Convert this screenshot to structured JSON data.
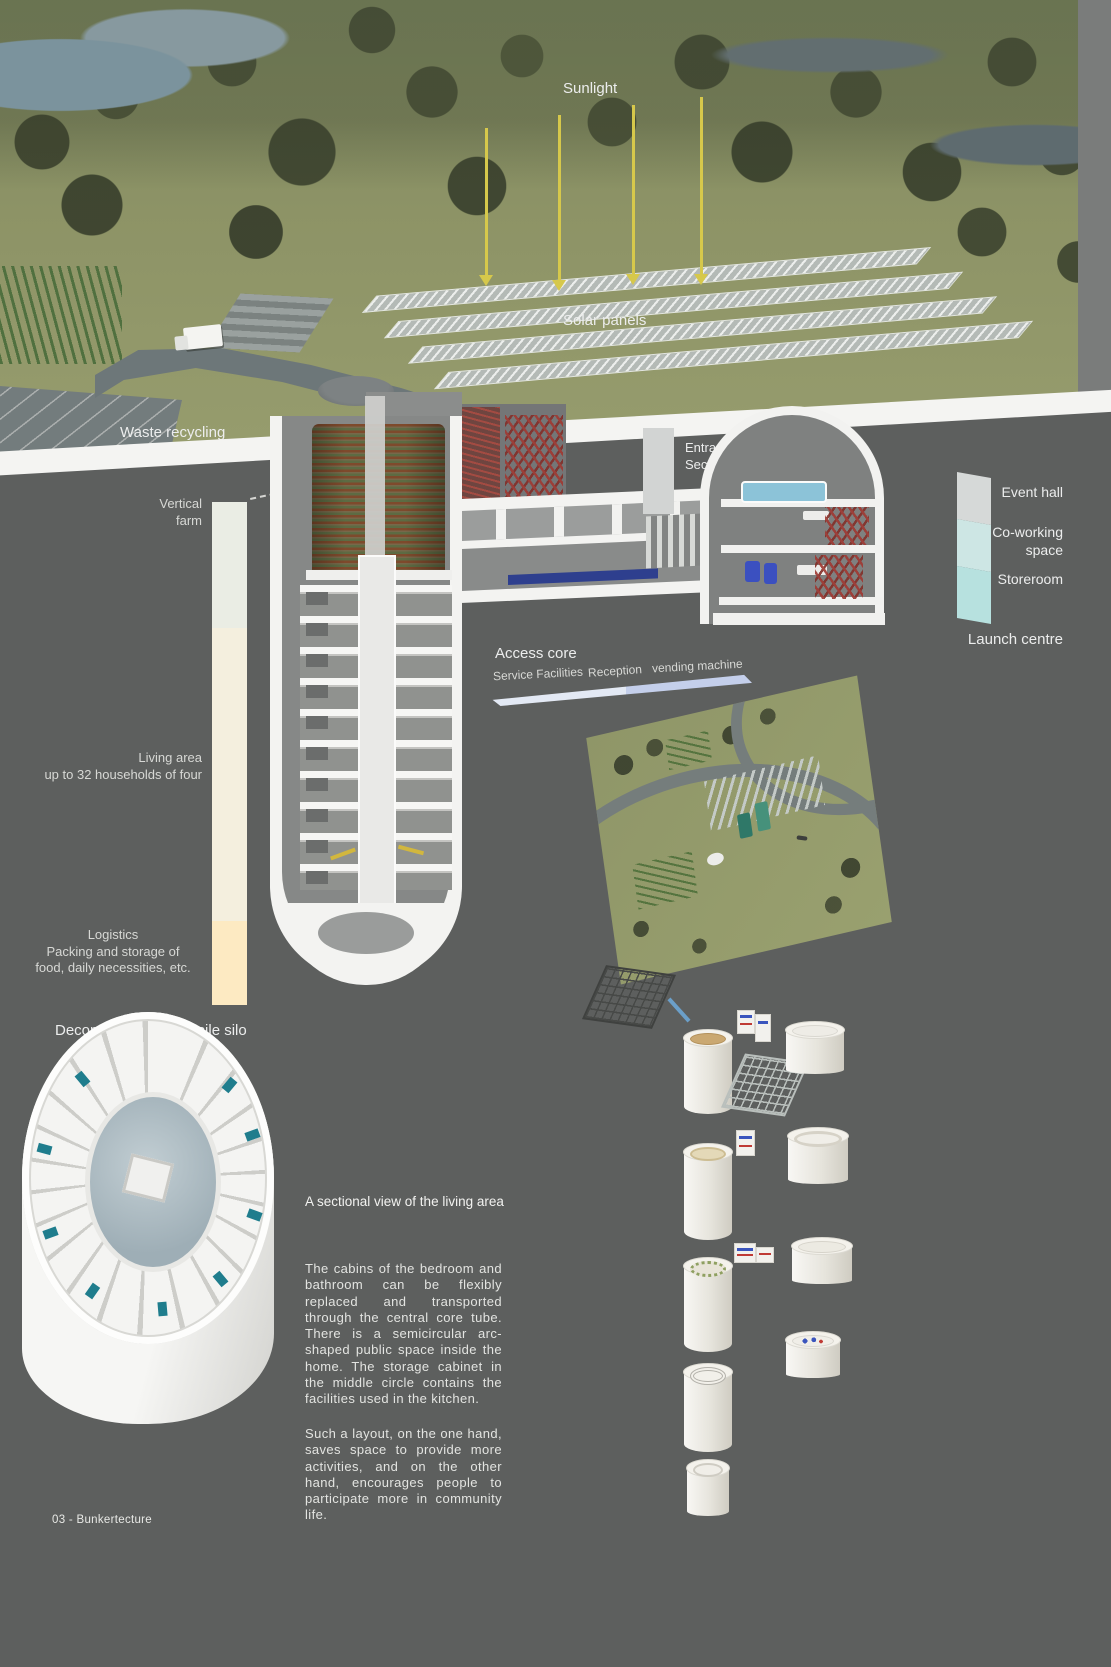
{
  "surface": {
    "sunlight": "Sunlight",
    "solar_panels": "Solar panels",
    "waste_recycling": "Waste recycling"
  },
  "underground": {
    "entrance": "Entrance\nSecurity check",
    "access_core": "Access core",
    "service_facilities": "Service Facilities",
    "reception": "Reception",
    "vending_machine": "vending machine",
    "launch_centre": "Launch centre",
    "silo_caption": "Decommissioned missile silo"
  },
  "left_legend": {
    "items": [
      {
        "label": "Vertical\nfarm",
        "color": "#eaede4"
      },
      {
        "label": "Living area\nup to 32 households of four",
        "color": "#f4efde"
      },
      {
        "label": "Logistics\nPacking and storage of\nfood, daily necessities, etc.",
        "color": "#fdeac2"
      }
    ]
  },
  "right_legend": {
    "items": [
      {
        "label": "Event hall",
        "color": "#d6d9d8"
      },
      {
        "label": "Co-working\nspace",
        "color": "#cde6e4"
      },
      {
        "label": "Storeroom",
        "color": "#b7e1df"
      }
    ]
  },
  "living_detail": {
    "heading": "A sectional view of the living area",
    "paragraph_1": "The cabins of the bedroom and bathroom can be flexibly replaced and transported through the central core tube. There is a semicircular arc-shaped public space inside the home. The storage cabinet in the middle circle contains the facilities used in the kitchen.",
    "paragraph_2": "Such a layout, on the one hand, saves space to provide more activities, and on the other hand, encourages people to participate more in community life."
  },
  "footer": "03 - Bunkertecture"
}
